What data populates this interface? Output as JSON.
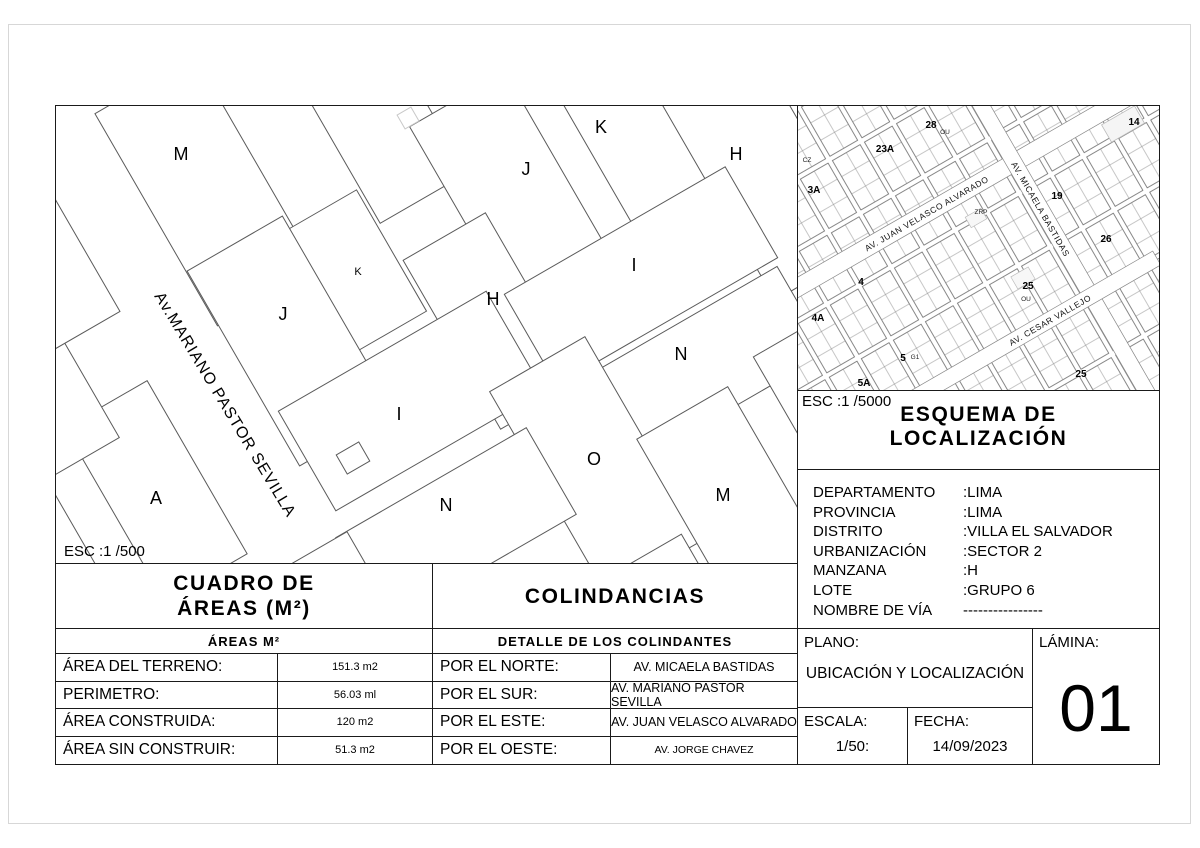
{
  "main_plan": {
    "scale": "ESC :1 /500",
    "street": "Av.MARIANO PASTOR SEVILLA",
    "labels": [
      "M",
      "J",
      "K",
      "H",
      "K",
      "J",
      "H",
      "I",
      "N",
      "I",
      "O",
      "N",
      "M",
      "A"
    ]
  },
  "esquema": {
    "scale": "ESC :1 /5000",
    "title1": "ESQUEMA DE",
    "title2": "LOCALIZACIÓN",
    "streets": [
      "AV. JUAN VELASCO ALVARADO",
      "AV. MICAELA BASTIDAS",
      "AV. CESAR VALLEJO"
    ],
    "blocks": [
      "28",
      "23A",
      "3A",
      "14",
      "19",
      "25",
      "4",
      "4A",
      "5",
      "5A",
      "25",
      "26",
      "OU",
      "CZ",
      "ZRP",
      "OU",
      "G1"
    ]
  },
  "location": {
    "rows": [
      {
        "label": "DEPARTAMENTO",
        "value": ":LIMA"
      },
      {
        "label": "PROVINCIA",
        "value": ":LIMA"
      },
      {
        "label": "DISTRITO",
        "value": ":VILLA EL SALVADOR"
      },
      {
        "label": "URBANIZACIÓN",
        "value": ":SECTOR 2"
      },
      {
        "label": "MANZANA",
        "value": ":H"
      },
      {
        "label": "LOTE",
        "value": ":GRUPO 6"
      },
      {
        "label": "NOMBRE DE VÍA",
        "value": "----------------"
      }
    ]
  },
  "areas": {
    "title1": "CUADRO DE",
    "title2": "ÁREAS (M²)",
    "subtitle": "ÁREAS M²",
    "rows": [
      {
        "label": "ÁREA DEL TERRENO:",
        "value": "151.3 m2"
      },
      {
        "label": "PERIMETRO:",
        "value": "56.03 ml"
      },
      {
        "label": "ÁREA CONSTRUIDA:",
        "value": "120 m2"
      },
      {
        "label": "ÁREA SIN CONSTRUIR:",
        "value": "51.3 m2"
      }
    ]
  },
  "colindancias": {
    "title": "COLINDANCIAS",
    "subtitle": "DETALLE DE LOS COLINDANTES",
    "rows": [
      {
        "label": "POR EL NORTE:",
        "value": "AV. MICAELA BASTIDAS"
      },
      {
        "label": "POR EL SUR:",
        "value": "AV. MARIANO PASTOR SEVILLA"
      },
      {
        "label": "POR EL ESTE:",
        "value": "AV. JUAN VELASCO ALVARADO"
      },
      {
        "label": "POR EL OESTE:",
        "value": "AV. JORGE CHAVEZ"
      }
    ]
  },
  "titleblock": {
    "plano_label": "PLANO:",
    "plano": "UBICACIÓN Y LOCALIZACIÓN",
    "lamina_label": "LÁMINA:",
    "lamina": "01",
    "escala_label": "ESCALA:",
    "escala": "1/50:",
    "fecha_label": "FECHA:",
    "fecha": "14/09/2023"
  }
}
